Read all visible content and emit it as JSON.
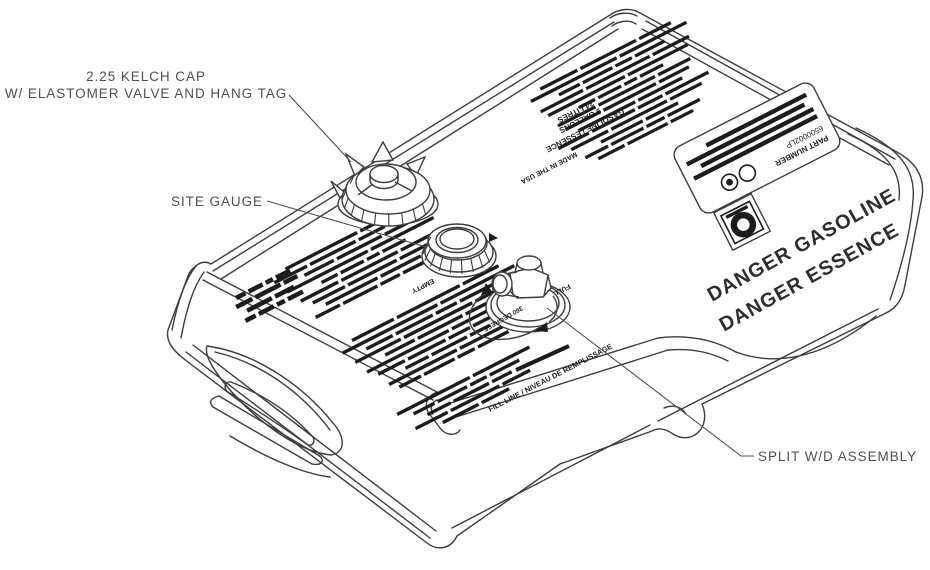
{
  "callouts": {
    "kelch_cap_line1": "2.25 KELCH CAP",
    "kelch_cap_line2": "W/ ELASTOMER VALVE AND HANG TAG",
    "site_gauge": "SITE GAUGE",
    "split_wd": "SPLIT W/D ASSEMBLY"
  },
  "tank_markings": {
    "danger_line1": "DANGER GASOLINE",
    "danger_line2": "DANGER ESSENCE",
    "fill_line": "FILL LINE / NIVEAU DE REMPLISSAGE",
    "gauge_empty": "EMPTY",
    "spout_full": "FULL",
    "rotation_note": "360 DEGREES",
    "part_label_line1": "PART NUMBER",
    "part_label_line2": "6500002LP",
    "capacity_line1": "GASOLINE / ESSENCE",
    "capacity_line2": "9 GALLONS",
    "capacity_line3": "34 LITRES",
    "origin": "MADE IN THE USA"
  },
  "colors": {
    "line": "#3d3d3d",
    "ink": "#1c1c1c",
    "text": "#4f4f4f",
    "background": "#ffffff"
  }
}
